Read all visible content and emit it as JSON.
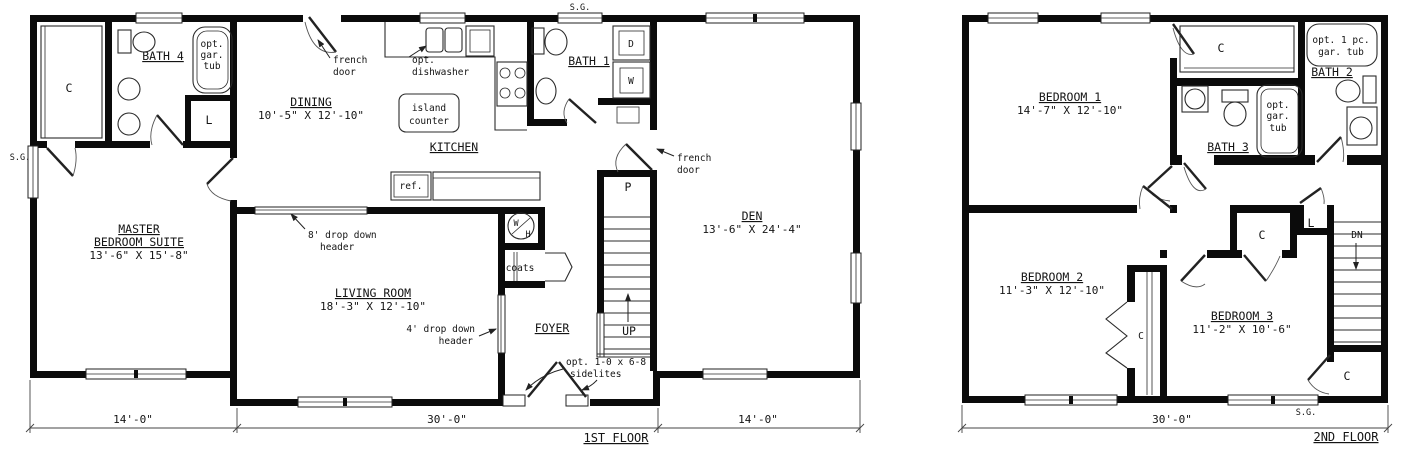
{
  "glyphs": {
    "sg": "S.G.",
    "closet": "C",
    "linen": "L",
    "pantry": "P",
    "dryer": "D",
    "washer": "W",
    "water_heater_w": "W",
    "water_heater_h": "H",
    "ref": "ref.",
    "coats": "coats",
    "up": "UP",
    "dn": "DN"
  },
  "annotations": {
    "french_1": "french",
    "french_2": "door",
    "dishwasher_1": "opt.",
    "dishwasher_2": "dishwasher",
    "island_1": "island",
    "island_2": "counter",
    "header8_1": "8' drop down",
    "header8_2": "header",
    "header4_1": "4' drop down",
    "header4_2": "header",
    "sidelites_1": "opt. 1-0 x 6-8",
    "sidelites_2": "sidelites",
    "gar_tub_1": "opt.",
    "gar_tub_2": "gar.",
    "gar_tub_3": "tub",
    "tub_1pc_1": "opt. 1 pc.",
    "tub_1pc_2": "gar. tub"
  },
  "first_floor": {
    "title": "1ST FLOOR",
    "rooms": {
      "master_1": "MASTER",
      "master_2": "BEDROOM SUITE",
      "master_dims": "13'-6\" X 15'-8\"",
      "dining": "DINING",
      "dining_dims": "10'-5\" X 12'-10\"",
      "kitchen": "KITCHEN",
      "living": "LIVING ROOM",
      "living_dims": "18'-3\" X 12'-10\"",
      "den": "DEN",
      "den_dims": "13'-6\" X 24'-4\"",
      "foyer": "FOYER",
      "bath1": "BATH 1",
      "bath4": "BATH 4"
    },
    "dims": {
      "left": "14'-0\"",
      "middle": "30'-0\"",
      "right": "14'-0\""
    }
  },
  "second_floor": {
    "title": "2ND FLOOR",
    "rooms": {
      "bed1": "BEDROOM 1",
      "bed1_dims": "14'-7\" X 12'-10\"",
      "bed2": "BEDROOM 2",
      "bed2_dims": "11'-3\" X 12'-10\"",
      "bed3": "BEDROOM 3",
      "bed3_dims": "11'-2\" X 10'-6\"",
      "bath2": "BATH 2",
      "bath3": "BATH 3"
    },
    "dims": {
      "width": "30'-0\""
    }
  }
}
